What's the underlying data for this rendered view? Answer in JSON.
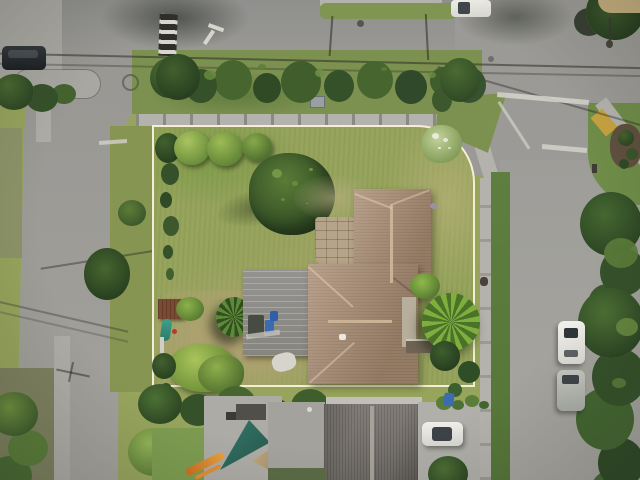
{
  "scene": {
    "type": "aerial-drone-photo",
    "subject": "Top-down drone view of a corner residential lot outlined with a white property boundary, at the intersection of two suburban streets",
    "boundary_overlay": {
      "label": "property-boundary",
      "color": "#f4eed6",
      "shape": "rectangle with rounded corner following the street curve"
    },
    "objects": [
      "tan hip-roof house",
      "grey flat-roof garage",
      "rust backyard shed",
      "paver patio",
      "palm trees",
      "hedge rows",
      "round trimmed bushes",
      "patchy lawn",
      "street intersection",
      "sidewalks",
      "landscaped traffic median",
      "crosswalk stop bars",
      "white turn-arrow road marking",
      "striped crosswalk panel",
      "yellow tactile curb ramp",
      "mulch planting bed",
      "parked cars",
      "trash and recycling bins",
      "teal shade sail",
      "orange kayak",
      "teal kayak",
      "overhead power lines",
      "pole shadows",
      "neighboring grey-roof house",
      "driveway with white car"
    ]
  },
  "palette": {
    "road": "#9b9a96",
    "sidewalk": "#b4b2ac",
    "lawn": "#96a45c",
    "swale_green": "#7c9150",
    "tree_dark": "#35512a",
    "tree_light": "#83a54c",
    "roof_tan": "#ac8f75",
    "roof_ridge": "#cbb295",
    "garage_grey": "#8f8e8a",
    "neighbor_roof_grey": "#7b7671",
    "boundary_white": "#f4eed6",
    "shade_sail_teal": "#2d685a",
    "shed_rust": "#7a4a33",
    "kayak_orange": "#d2752a",
    "kayak_teal": "#3e9f8b",
    "bin_blue": "#3c6cb0",
    "tactile_yellow": "#c6a23f",
    "mulch_brown": "#5f4f3e",
    "car_white": "#ebeae5",
    "car_dark": "#24282c",
    "car_silver": "#b7bbb3"
  }
}
